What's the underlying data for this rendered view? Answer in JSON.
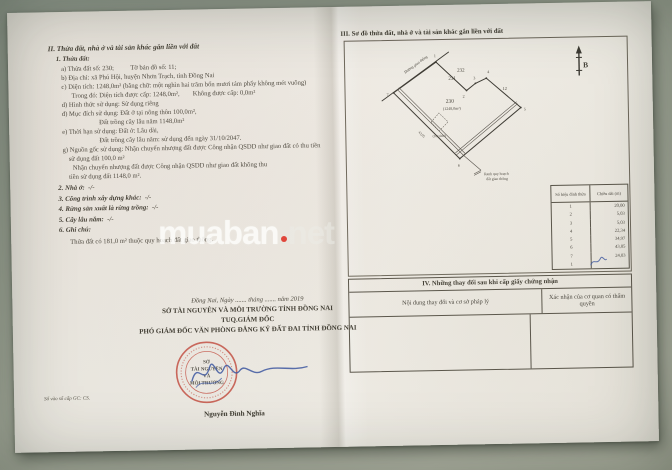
{
  "watermark": {
    "main": "muaban",
    "tld": "net"
  },
  "left": {
    "section2_title": "II. Thửa đất, nhà ở và tài sản khác gắn liền với đất",
    "item1": "1. Thửa đất:",
    "body": [
      "a) Thửa đất số: 230;          Tờ bản đồ số: 11;",
      "b) Địa chỉ: xã Phú Hội, huyện Nhơn Trạch, tỉnh Đồng Nai",
      "c) Diện tích: 1248,0m² (bằng chữ: một nghìn hai trăm bốn mươi tám phẩy không mét vuông)",
      "Trong đó: Diện tích được cấp: 1248,0m²,        Không được cấp: 0,0m²",
      "d) Hình thức sử dụng: Sử dụng riêng",
      "đ) Mục đích sử dụng: Đất ở tại nông thôn 100,0m²,",
      "Đất trồng cây lâu năm 1148,0m²",
      "e) Thời hạn sử dụng: Đất ở: Lâu dài,",
      "Đất trồng cây lâu năm: sử dụng đến ngày 31/10/2047.",
      "g) Nguồn gốc sử dụng: Nhận chuyển nhượng đất được Công nhận QSDD như giao đất có thu tiền",
      "sử dụng đất 100,0 m²",
      "Nhận chuyển nhượng đất được Công nhận QSDD như giao đất không thu",
      "tiền sử dụng đất 1148,0 m²."
    ],
    "items": [
      "2. Nhà ở:  -/-",
      "3. Công trình xây dựng khác:  -/-",
      "4. Rừng sản xuất là rừng trồng:  -/-",
      "5. Cây lâu năm:  -/-",
      "6. Ghi chú:"
    ],
    "note": "Thửa đất có 181,0 m² thuộc quy hoạch đất giao thông.",
    "sign": {
      "date": "Đồng Nai, Ngày ....... tháng ....... năm 2019",
      "org": "SỞ TÀI NGUYÊN VÀ MÔI TRƯỜNG TỈNH ĐỒNG NAI",
      "tuq": "TUQ.GIÁM ĐỐC",
      "role": "PHÓ GIÁM ĐỐC VĂN PHÒNG ĐĂNG KÝ ĐẤT ĐAI TỈNH ĐỒNG NAI",
      "signer": "Nguyễn Đình Nghĩa",
      "stamp_lines": [
        "SỞ",
        "TÀI NGUYÊN",
        "VÀ",
        "MÔI TRƯỜNG"
      ]
    },
    "footnote": "Số vào sổ cấp GC: CS."
  },
  "right": {
    "section3_title": "III. Sơ đồ thửa đất, nhà ở và tài sản khác gắn liền với đất",
    "diagram": {
      "north": "B",
      "parcel_232": "232",
      "parcel_231": "231",
      "parcel_230": "230",
      "parcel_area": "(1248,0m²)",
      "edge_label": "12",
      "edge_length_left": "43,05",
      "road": "Đường giao thông",
      "planned_area": "(181,0m²)",
      "legend1": "Ranh quy hoạch",
      "legend2": "đất giao thông",
      "vertices": [
        "1",
        "2",
        "3",
        "4",
        "5",
        "6",
        "7"
      ]
    },
    "table": {
      "header1": "Số hiệu đỉnh thửa",
      "header2": "Chiều dài (m)",
      "rows": [
        [
          "1",
          "20,00"
        ],
        [
          "2",
          "5,03"
        ],
        [
          "3",
          "5,03"
        ],
        [
          "4",
          "22,34"
        ],
        [
          "5",
          "34,97"
        ],
        [
          "6",
          "43,05"
        ],
        [
          "7",
          "24,03"
        ],
        [
          "1",
          ""
        ]
      ]
    },
    "section4": {
      "title": "IV. Những thay đổi sau khi cấp giấy chứng nhận",
      "col1": "Nội dung thay đổi và cơ sở pháp lý",
      "col2": "Xác nhận của cơ quan có thẩm quyền"
    }
  }
}
